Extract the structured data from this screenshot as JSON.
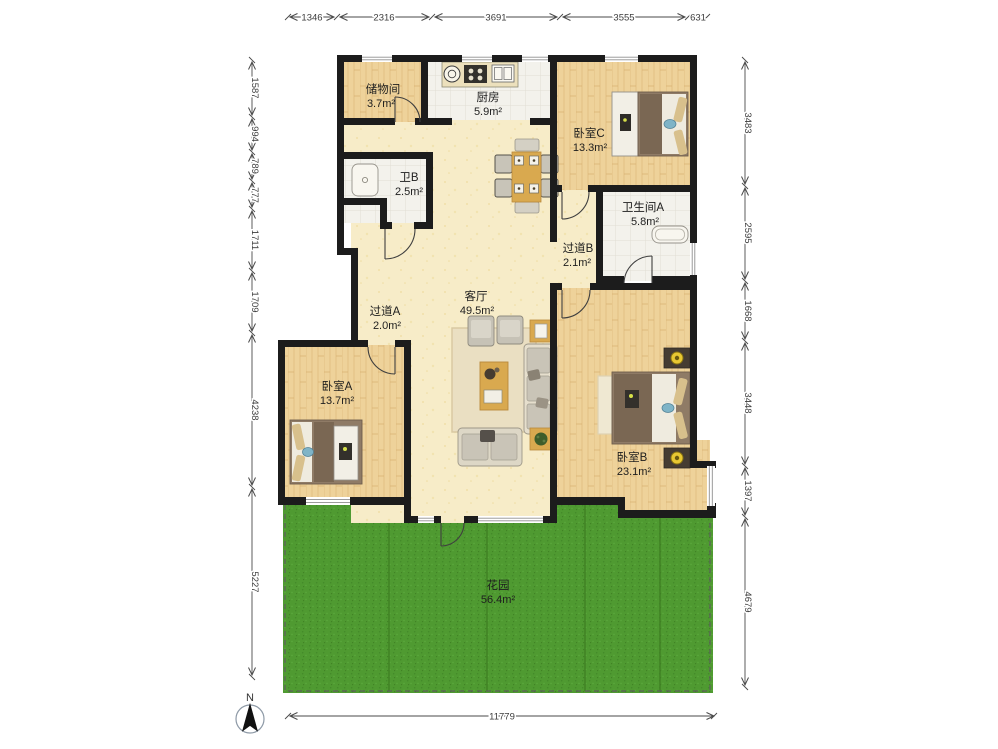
{
  "plan": {
    "rooms": {
      "storage": {
        "name": "储物间",
        "area": "3.7m²"
      },
      "kitchen": {
        "name": "厨房",
        "area": "5.9m²"
      },
      "bedroom_c": {
        "name": "卧室C",
        "area": "13.3m²"
      },
      "bath_b": {
        "name": "卫B",
        "area": "2.5m²"
      },
      "bath_a": {
        "name": "卫生间A",
        "area": "5.8m²"
      },
      "corridor_b": {
        "name": "过道B",
        "area": "2.1m²"
      },
      "corridor_a": {
        "name": "过道A",
        "area": "2.0m²"
      },
      "living": {
        "name": "客厅",
        "area": "49.5m²"
      },
      "bedroom_a": {
        "name": "卧室A",
        "area": "13.7m²"
      },
      "bedroom_b": {
        "name": "卧室B",
        "area": "23.1m²"
      },
      "garden": {
        "name": "花园",
        "area": "56.4m²"
      }
    },
    "dimensions": {
      "top": [
        "1346",
        "2316",
        "3691",
        "3555",
        "631"
      ],
      "left": [
        "1587",
        "994",
        "789",
        "777",
        "1711",
        "1709",
        "4238",
        "5227"
      ],
      "right": [
        "3483",
        "2595",
        "1668",
        "3448",
        "1397",
        "4679"
      ],
      "bottom": [
        "11779"
      ]
    },
    "compass": {
      "label": "N"
    },
    "colors": {
      "wall": "#1c1c1c",
      "wood_floor": "#eed29a",
      "tile_floor": "#f3f2ec",
      "living_floor": "#f7ecc8",
      "garden": "#4f9a31"
    }
  }
}
